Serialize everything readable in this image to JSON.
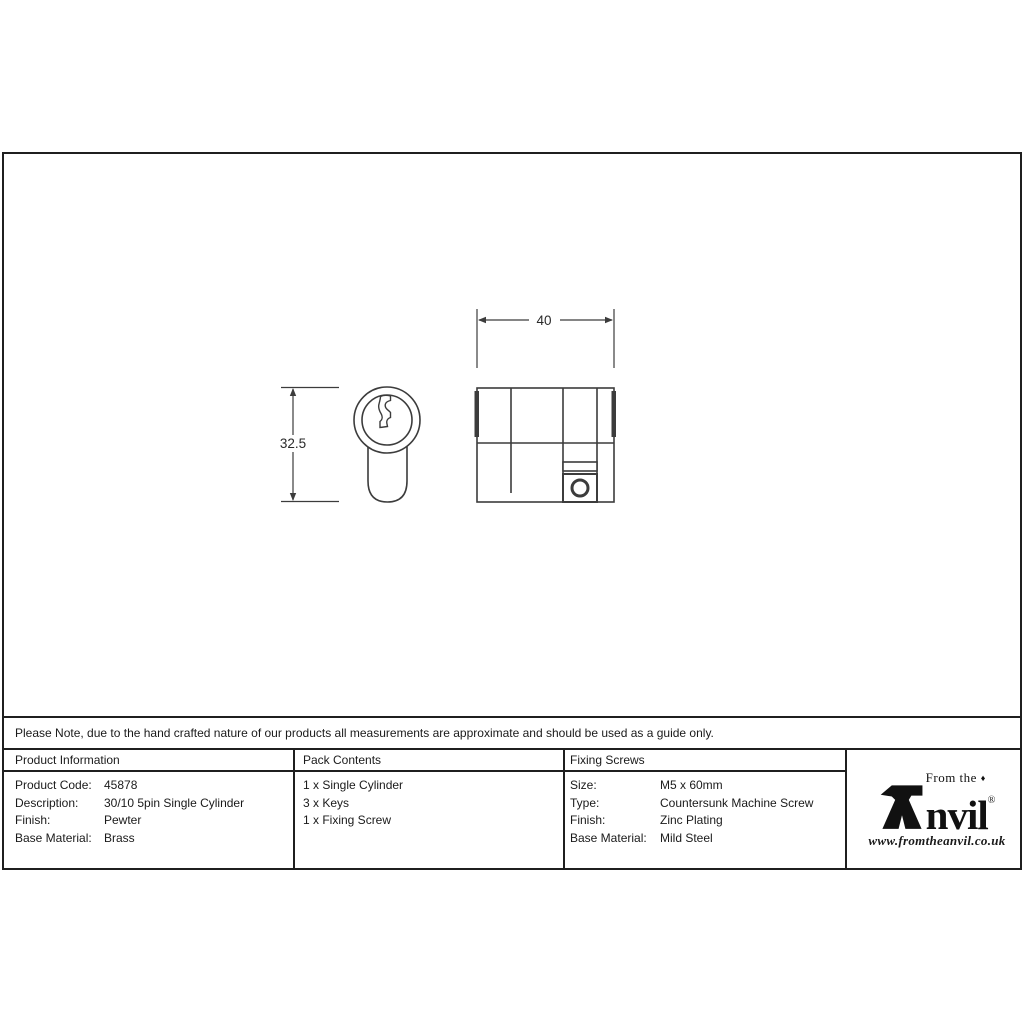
{
  "colors": {
    "frame_border": "#1f1f1f",
    "drawing_line": "#3c3c3c",
    "text": "#1a1a1a"
  },
  "drawing": {
    "width_dim": "40",
    "height_dim": "32.5"
  },
  "note_bar": {
    "text": "Please Note, due to the hand crafted nature of our products all measurements are approximate and should be used as a guide only."
  },
  "table": {
    "product_information": {
      "title": "Product Information",
      "rows": [
        {
          "label": "Product Code:",
          "value": "45878"
        },
        {
          "label": "Description:",
          "value": "30/10 5pin Single Cylinder"
        },
        {
          "label": "Finish:",
          "value": "Pewter"
        },
        {
          "label": "Base Material:",
          "value": "Brass"
        }
      ]
    },
    "pack_contents": {
      "title": "Pack Contents",
      "items": [
        "1 x Single Cylinder",
        "3 x Keys",
        "1 x Fixing Screw"
      ]
    },
    "fixing_screws": {
      "title": "Fixing Screws",
      "rows": [
        {
          "label": "Size:",
          "value": "M5 x 60mm"
        },
        {
          "label": "Type:",
          "value": "Countersunk Machine Screw"
        },
        {
          "label": "Finish:",
          "value": "Zinc Plating"
        },
        {
          "label": "Base Material:",
          "value": "Mild Steel"
        }
      ]
    }
  },
  "logo": {
    "tagline": "From the",
    "diamond": "♦",
    "wordmark_rest": "nvil",
    "registered": "®",
    "website": "www.fromtheanvil.co.uk"
  }
}
